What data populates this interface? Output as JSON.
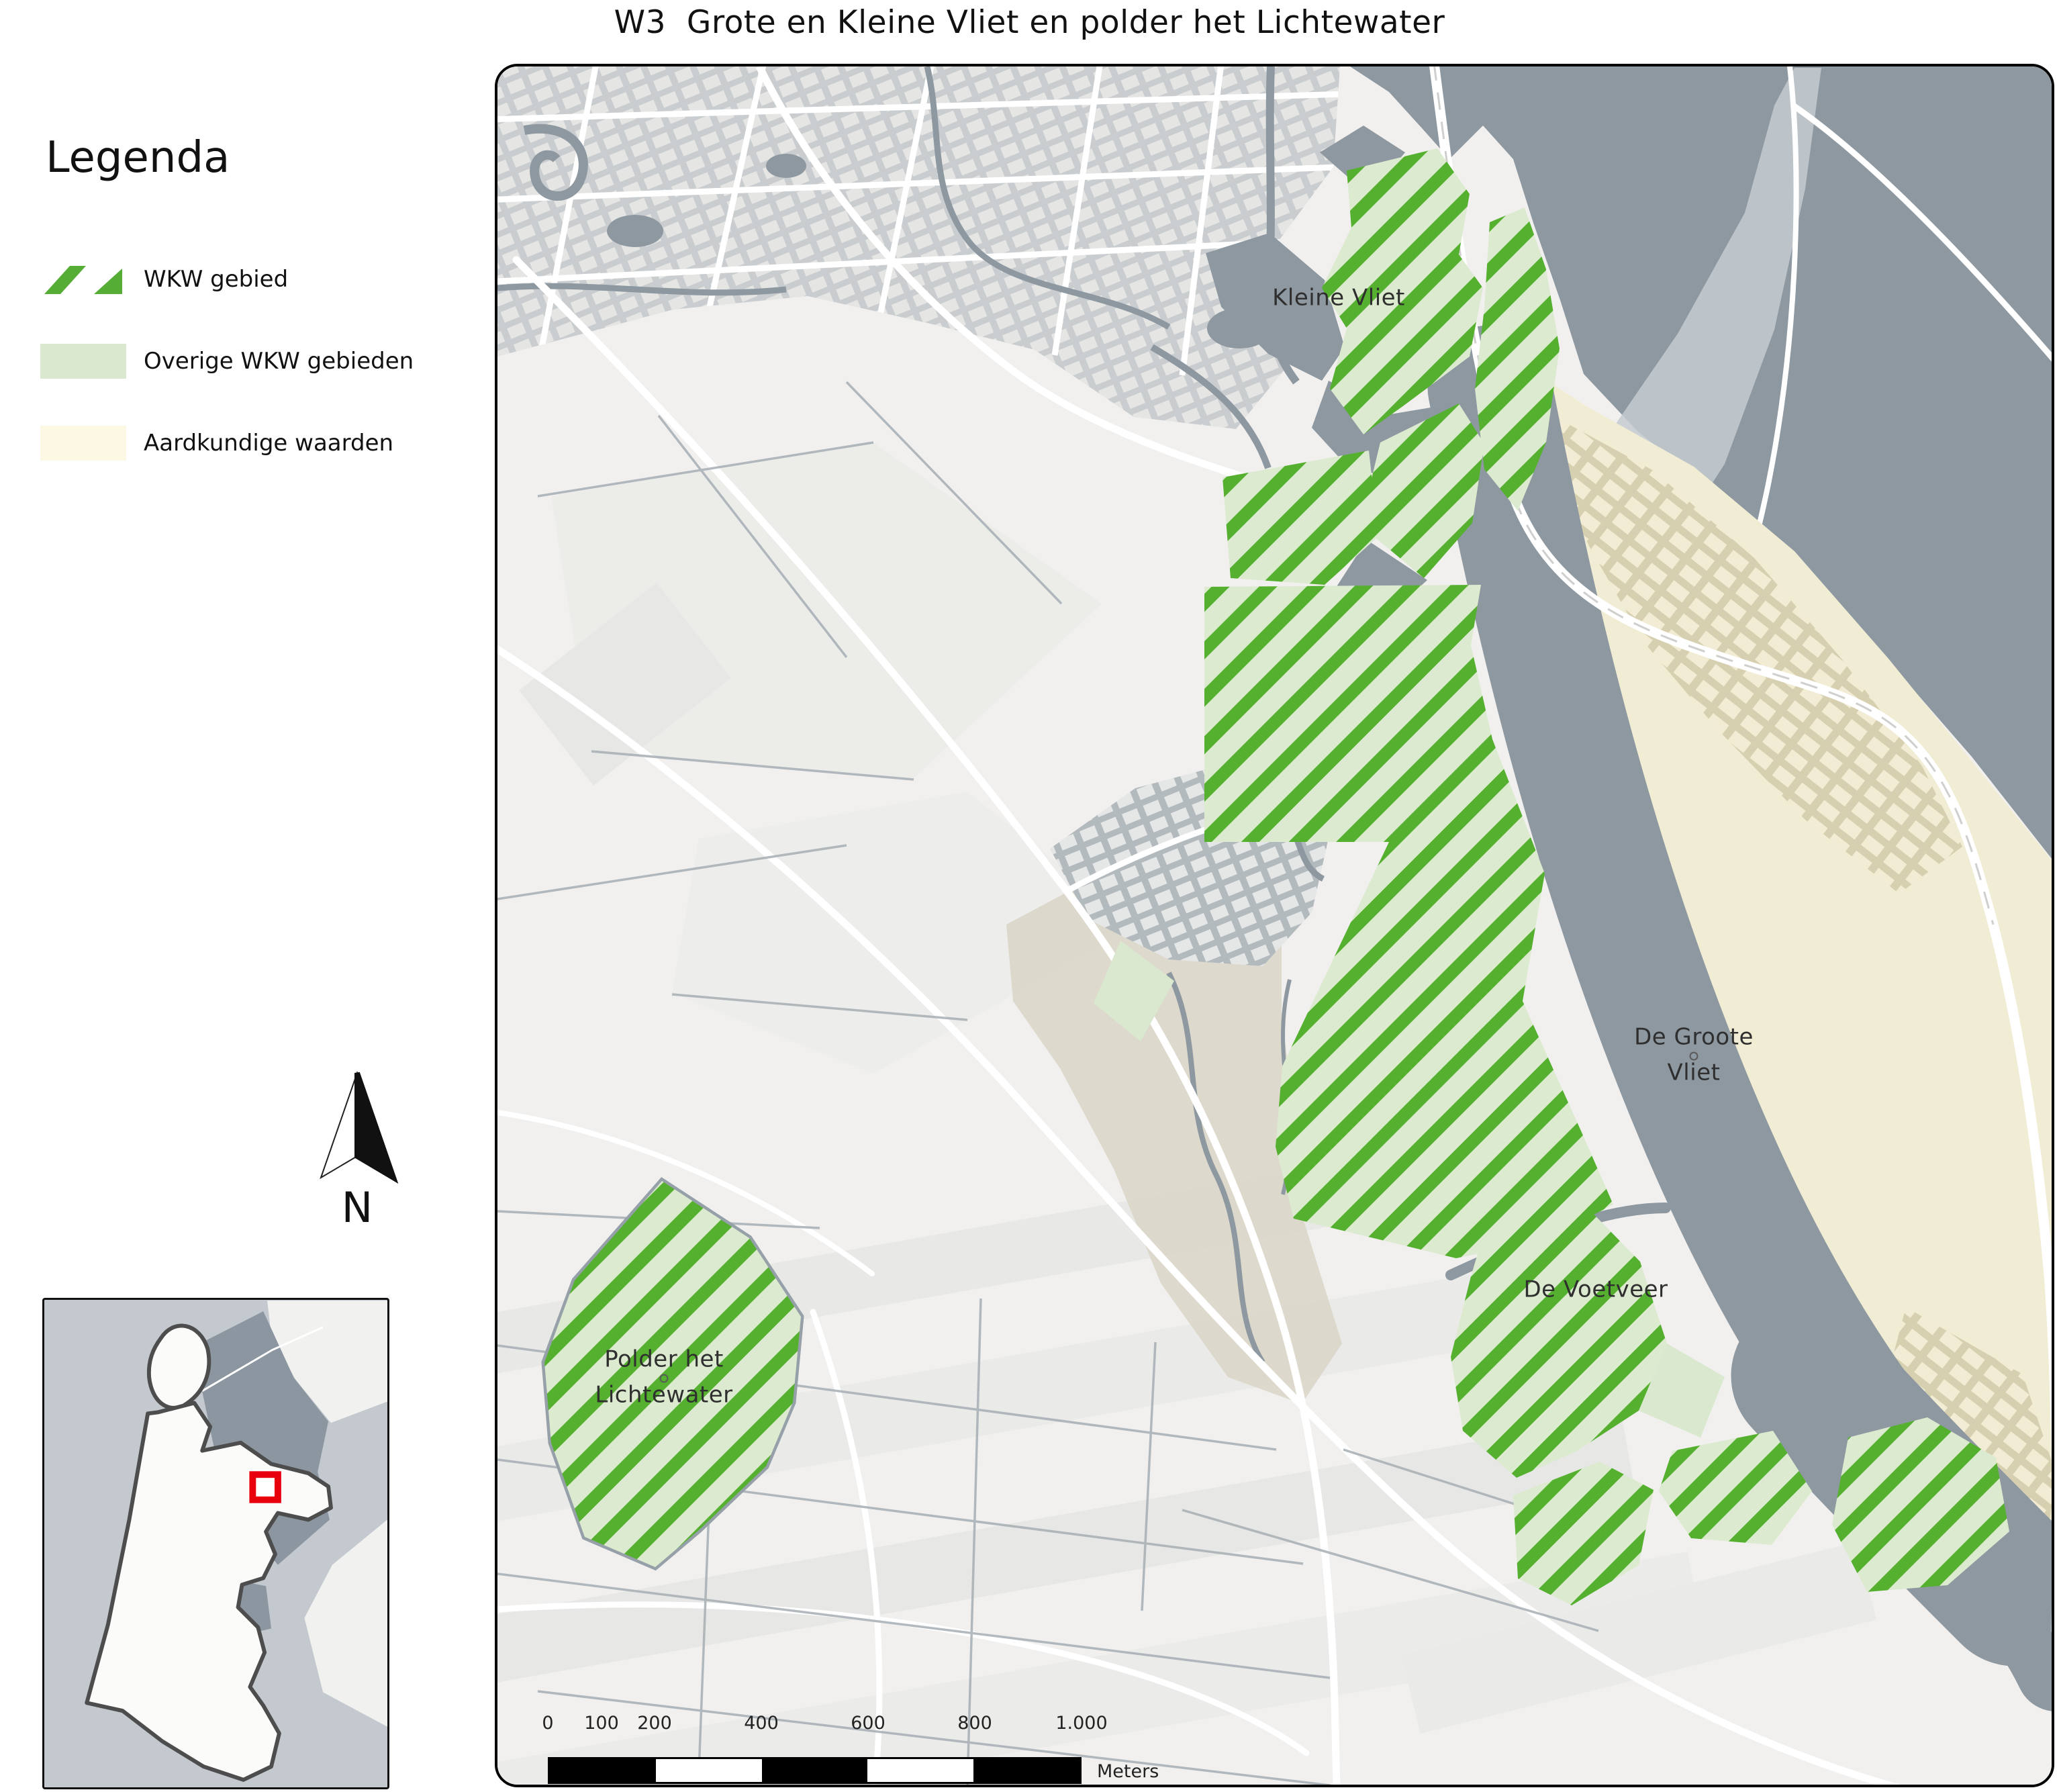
{
  "title": "W3  Grote en Kleine Vliet en polder het Lichtewater",
  "legend": {
    "title": "Legenda",
    "items": [
      {
        "label": "WKW gebied",
        "type": "hatch",
        "color": "#55ad35"
      },
      {
        "label": "Overige WKW gebieden",
        "type": "fill",
        "color": "#d9e8cf"
      },
      {
        "label": "Aardkundige waarden",
        "type": "fill",
        "color": "#fdf8e4"
      }
    ]
  },
  "map": {
    "labels": {
      "kleine_vliet": "Kleine Vliet",
      "de_groote_vliet": "De Groote\nVliet",
      "de_voetveer": "De Voetveer",
      "polder_het_lichtewater": "Polder het\nLichtewater"
    }
  },
  "north_label": "N",
  "scalebar": {
    "ticks": [
      "0",
      "100",
      "200",
      "400",
      "600",
      "800",
      "1.000"
    ],
    "unit": "Meters"
  },
  "colors": {
    "wkw_stripe": "#54b02e",
    "wkw_fill": "#dcead0",
    "overige_wkw": "#d9e8cf",
    "aardkundige": "#fdf8e4",
    "water": "#8e98a1",
    "land": "#f1f0ee",
    "cream_area": "#f1ecd4",
    "marker_red": "#e8000d"
  }
}
